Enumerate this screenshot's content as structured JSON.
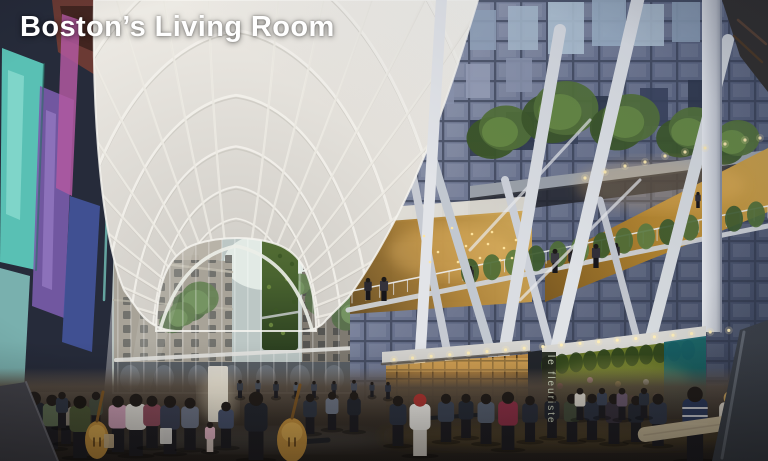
{
  "slide": {
    "title": "Boston’s Living Room"
  },
  "scene": {
    "florist_sign": "le fleuriste",
    "colors": {
      "title_text": "#ffffff",
      "canopy_white": "#ece9e2",
      "facade_dusk_blue": "#4e5870",
      "warm_interior_gold": "#c9973f",
      "living_wall_green": "#55703a",
      "florist_teal": "#17646a",
      "left_glass_teal": "#5fd0c2",
      "left_glass_purple": "#7a5cac",
      "ground_brown": "#3a322a"
    }
  }
}
